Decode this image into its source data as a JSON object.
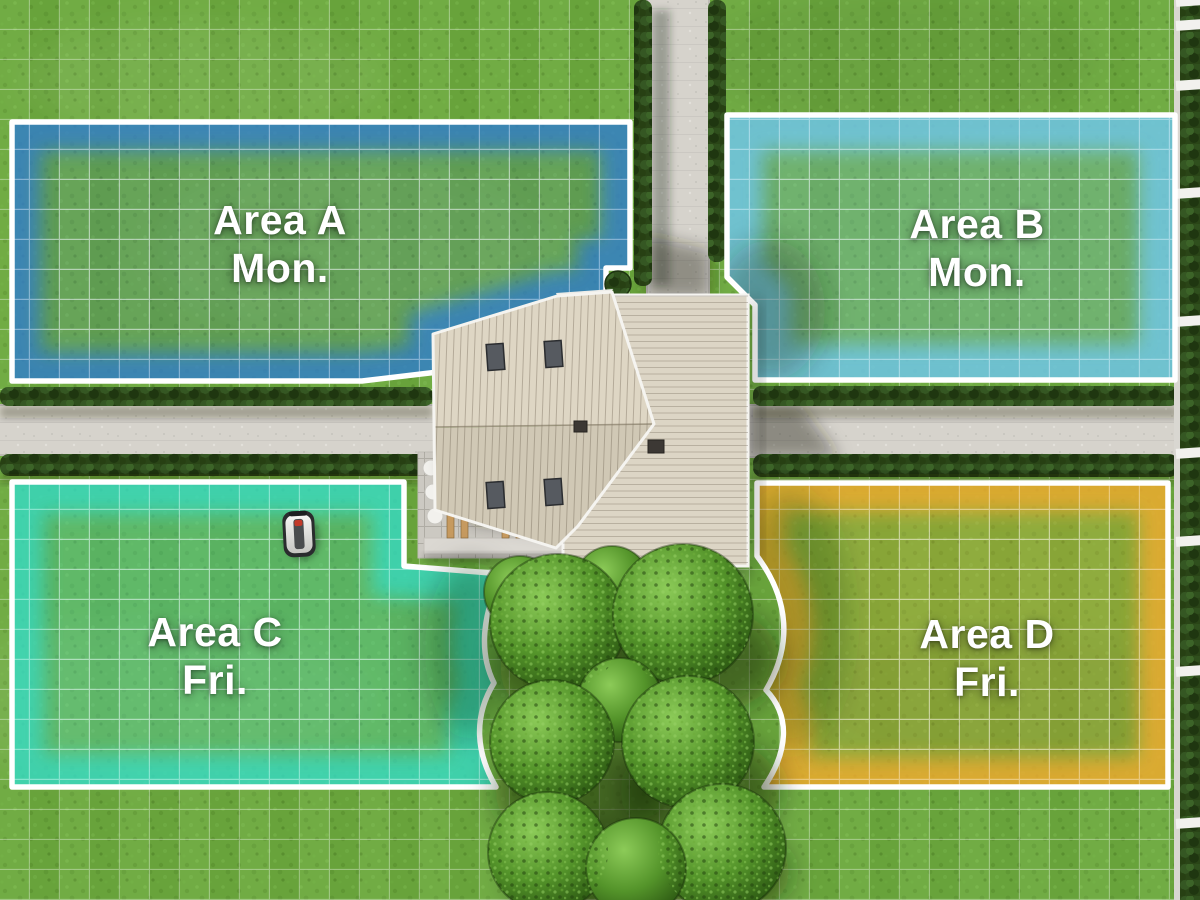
{
  "scene": {
    "description": "Top-down garden map with robotic mower zones",
    "width_px": 1200,
    "height_px": 900
  },
  "zones": [
    {
      "id": "A",
      "label": "Area A",
      "day": "Mon.",
      "color": "#2f7bd0"
    },
    {
      "id": "B",
      "label": "Area B",
      "day": "Mon.",
      "color": "#6fc6e8"
    },
    {
      "id": "C",
      "label": "Area C",
      "day": "Fri.",
      "color": "#35dcc6"
    },
    {
      "id": "D",
      "label": "Area D",
      "day": "Fri.",
      "color": "#f0aa2f"
    }
  ],
  "colors": {
    "lawn": "#6ca93d",
    "grid_line": "#ffffff",
    "path_concrete": "#d6d3cc",
    "hedge_dark_green": "#2a4517",
    "roof_beige": "#d9d1c0",
    "gable_white": "#edece8",
    "tree_green": "#4e8f29",
    "zone_border_white": "#ffffff"
  },
  "mower": {
    "name": "robotic-mower",
    "body_color": "#efefec",
    "accent_color": "#c33a2a"
  }
}
